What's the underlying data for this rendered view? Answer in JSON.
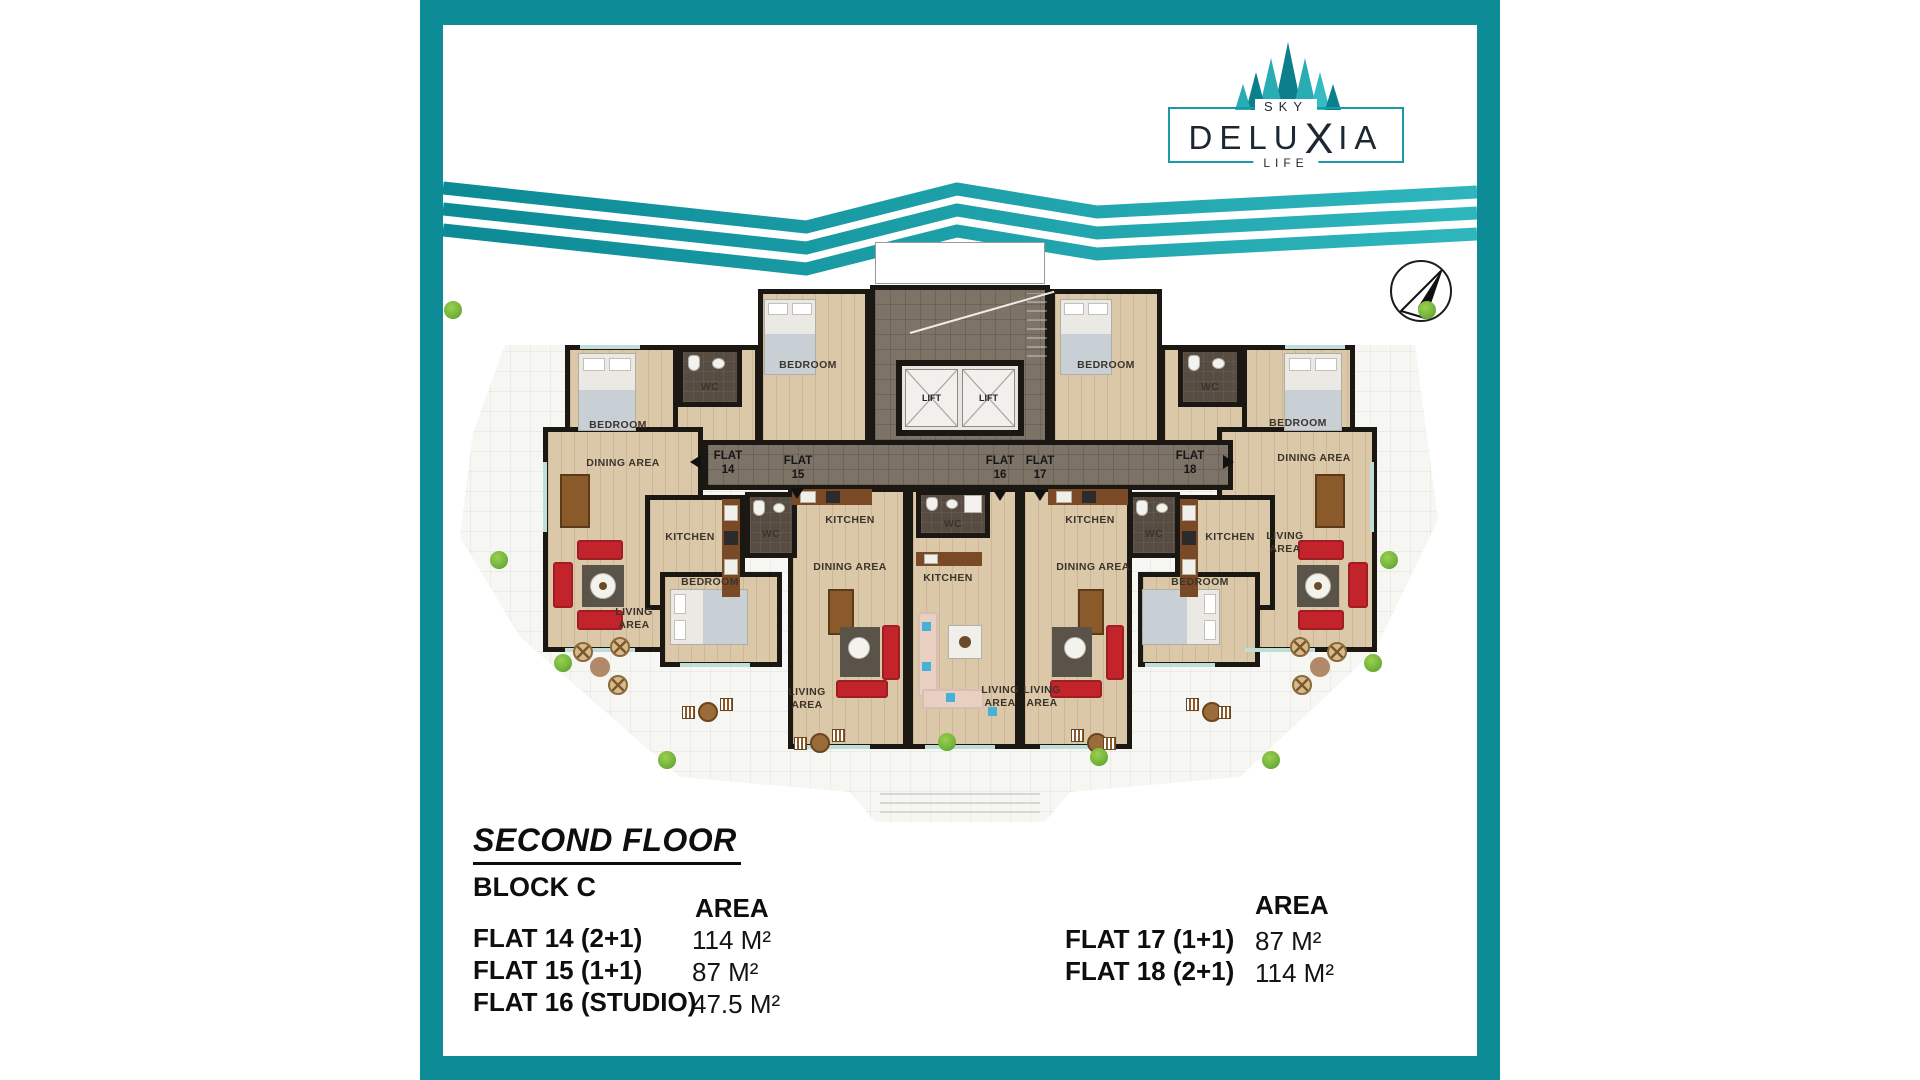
{
  "brand": {
    "sky": "SKY",
    "name_pre": "DELU",
    "name_x": "X",
    "name_post": "IA",
    "life": "LIFE"
  },
  "icons": {
    "trees": "pine-trees-logo",
    "compass": "north-arrow-compass"
  },
  "floor_info": {
    "title": "SECOND FLOOR",
    "block": "BLOCK C"
  },
  "area_tables": {
    "left": {
      "header": "AREA",
      "rows": [
        {
          "flat": "FLAT 14 (2+1)",
          "area": "114 M²"
        },
        {
          "flat": "FLAT 15 (1+1)",
          "area": "87 M²"
        },
        {
          "flat": "FLAT 16 (STUDIO)",
          "area": "47.5 M²"
        }
      ]
    },
    "right": {
      "header": "AREA",
      "rows": [
        {
          "flat": "FLAT 17 (1+1)",
          "area": "87 M²"
        },
        {
          "flat": "FLAT 18 (2+1)",
          "area": "114 M²"
        }
      ]
    }
  },
  "plan": {
    "labels": {
      "bedroom": "BEDROOM",
      "wc": "WC",
      "kitchen": "KITCHEN",
      "dining": "DINING AREA",
      "living1": "LIVING",
      "living2": "AREA",
      "lift": "LIFT"
    },
    "flats": {
      "word": "FLAT",
      "numbers": [
        "14",
        "15",
        "16",
        "17",
        "18"
      ]
    }
  },
  "colors": {
    "teal": "#0d8c98",
    "wave1": "#0c8a95",
    "wave2": "#2fb6bd",
    "wall": "#1b1814",
    "wood": "#dbc8a9",
    "corridor": "#7d7366",
    "wc": "#564c42",
    "terrace": "#f6f6f2",
    "sofa": "#c3242c",
    "rug": "#59534a",
    "counter": "#7a4a26",
    "bed": "#ebe9e4",
    "blanket": "#c9d0d5",
    "bush": "#6fb039",
    "glass": "#bfded8",
    "label": "#3b342b",
    "ink": "#0e0e0e",
    "logoink": "#1c2733",
    "logoborder": "#1a9aa8"
  }
}
